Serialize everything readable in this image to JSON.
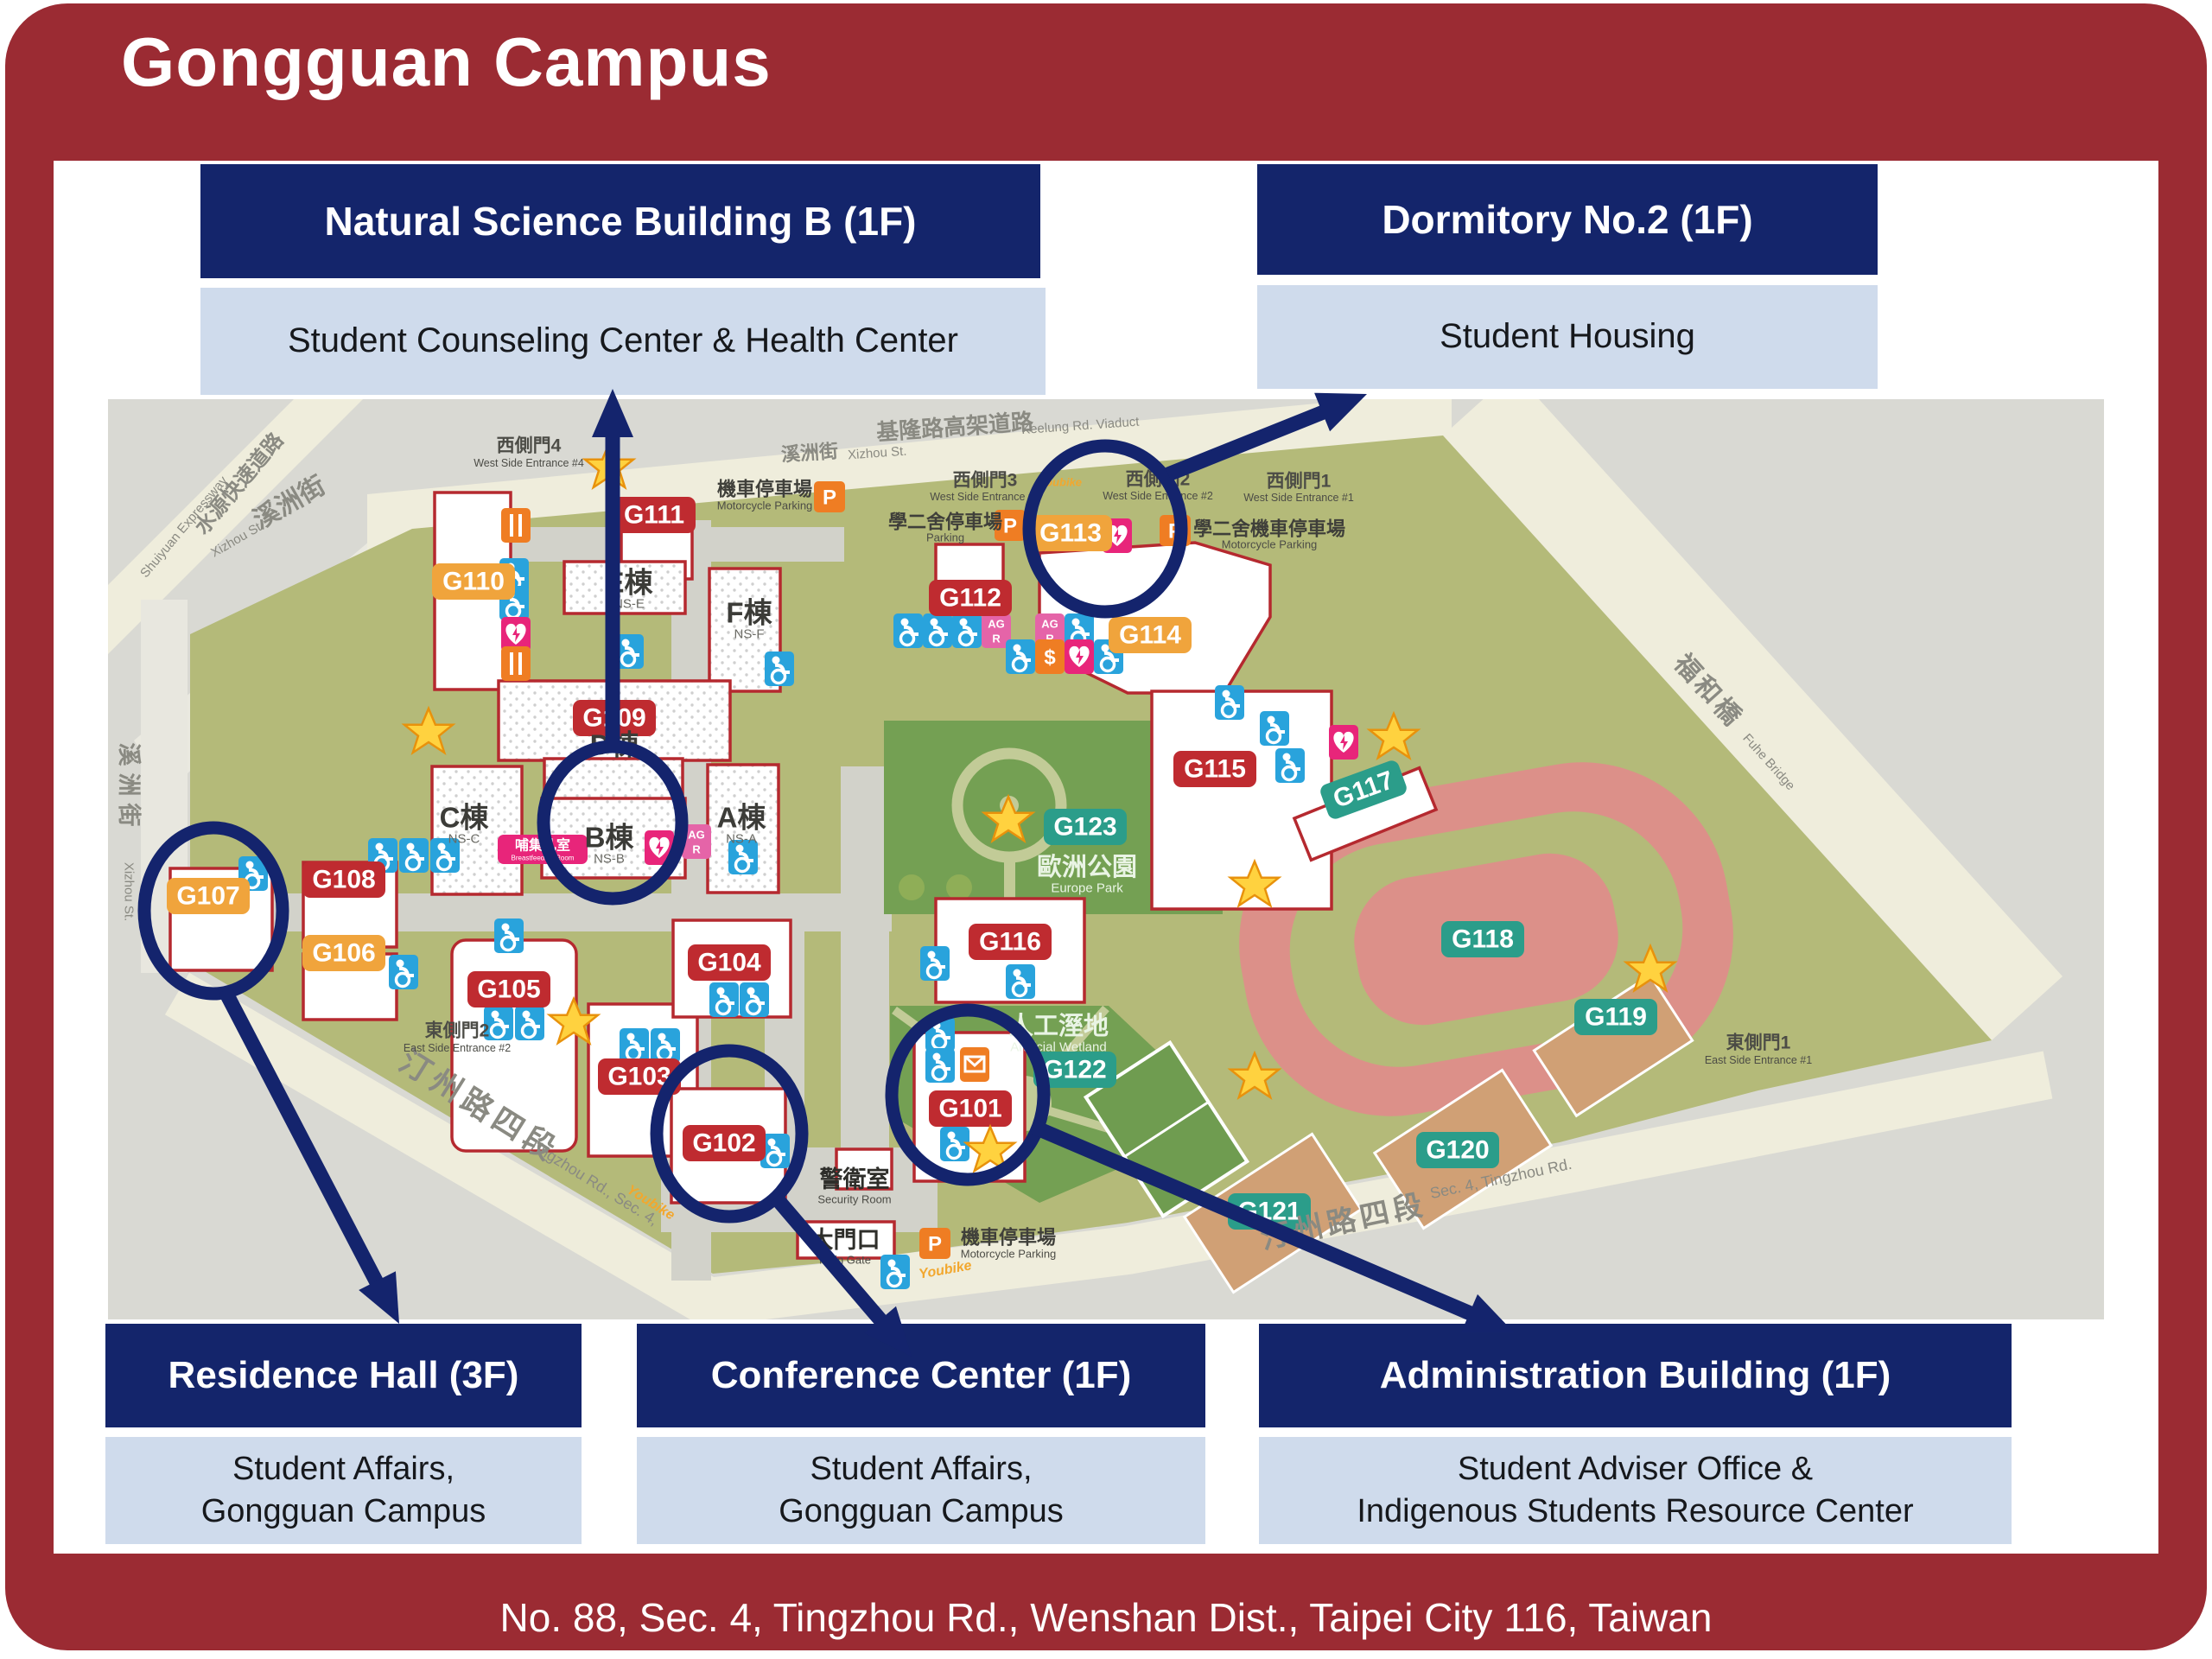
{
  "title": "Gongguan Campus",
  "address": "No. 88, Sec. 4, Tingzhou Rd., Wenshan Dist., Taipei City 116, Taiwan",
  "colors": {
    "frame_red": "#9B2B33",
    "navy": "#14256B",
    "light_panel": "#CFDBEC",
    "badge_red": "#BF2B30",
    "badge_orange": "#F0A43C",
    "badge_teal": "#2B9D8A",
    "campus_green": "#B4BA79",
    "park_green": "#74A053",
    "track_pink": "#DC9089",
    "star_yellow": "#FFD23F"
  },
  "callouts": {
    "natural_science": {
      "title": "Natural Science Building B (1F)",
      "subtitle": "Student Counseling Center & Health Center"
    },
    "dormitory": {
      "title": "Dormitory No.2 (1F)",
      "subtitle": "Student Housing"
    },
    "residence_hall": {
      "title": "Residence Hall (3F)",
      "line1": "Student Affairs,",
      "line2": "Gongguan Campus"
    },
    "conference_center": {
      "title": "Conference Center (1F)",
      "line1": "Student Affairs,",
      "line2": "Gongguan Campus"
    },
    "administration": {
      "title": "Administration Building (1F)",
      "line1": "Student Adviser Office &",
      "line2": "Indigenous Students Resource Center"
    }
  },
  "map": {
    "buildings": {
      "G101": "G101",
      "G102": "G102",
      "G103": "G103",
      "G104": "G104",
      "G105": "G105",
      "G106": "G106",
      "G107": "G107",
      "G108": "G108",
      "G109": "G109",
      "G110": "G110",
      "G111": "G111",
      "G112": "G112",
      "G113": "G113",
      "G114": "G114",
      "G115": "G115",
      "G116": "G116",
      "G117": "G117",
      "G118": "G118",
      "G119": "G119",
      "G120": "G120",
      "G121": "G121",
      "G122": "G122",
      "G123": "G123"
    },
    "ns_buildings": {
      "a": "A棟",
      "a_en": "NS-A",
      "b": "B棟",
      "b_en": "NS-B",
      "c": "C棟",
      "c_en": "NS-C",
      "d": "D棟",
      "e": "E棟",
      "e_en": "NS-E",
      "f": "F棟",
      "f_en": "NS-F"
    },
    "streets": {
      "keelung": "基隆路高架道路",
      "keelung_en": "Keelung Rd. Viaduct",
      "xizhou": "溪洲街",
      "xizhou_en": "Xizhou St.",
      "shuiyuan": "水源快速道路",
      "shuiyuan_en": "Shuiyuan Expressway",
      "fuhe": "福和橋",
      "fuhe_en": "Fuhe Bridge",
      "tingzhou": "汀州路四段",
      "tingzhou_en_left": "Tingzhou Rd., Sec. 4,",
      "tingzhou_en_right": "Sec. 4, Tingzhou Rd.",
      "youbike": "Youbike"
    },
    "entrances": {
      "w4": "西側門4",
      "w4_en": "West Side Entrance #4",
      "w3": "西側門3",
      "w3_en": "West Side Entrance #3",
      "w2": "西側門2",
      "w2_en": "West Side Entrance #2",
      "w1": "西側門1",
      "w1_en": "West Side Entrance #1",
      "e2": "東側門2",
      "e2_en": "East Side Entrance #2",
      "e1": "東側門1",
      "e1_en": "East Side Entrance #1"
    },
    "facilities": {
      "security": "警衛室",
      "security_en": "Security Room",
      "main_gate": "大門口",
      "main_gate_en": "Main Gate",
      "moto_parking": "機車停車場",
      "moto_parking_en": "Motorcycle Parking",
      "dorm2_parking": "學二舍停車場",
      "dorm2_parking_en": "Parking",
      "dorm2_moto": "學二舍機車停車場",
      "dorm2_moto_en": "Motorcycle Parking",
      "europe_park": "歐洲公園",
      "europe_park_en": "Europe Park",
      "wetland": "人工溼地",
      "wetland_en": "Artificial Wetland",
      "breastfeeding": "哺集乳室",
      "breastfeeding_en": "Breastfeeding Room",
      "p": "P",
      "agr1": "AG",
      "agr2": "R",
      "dollar": "$"
    }
  }
}
